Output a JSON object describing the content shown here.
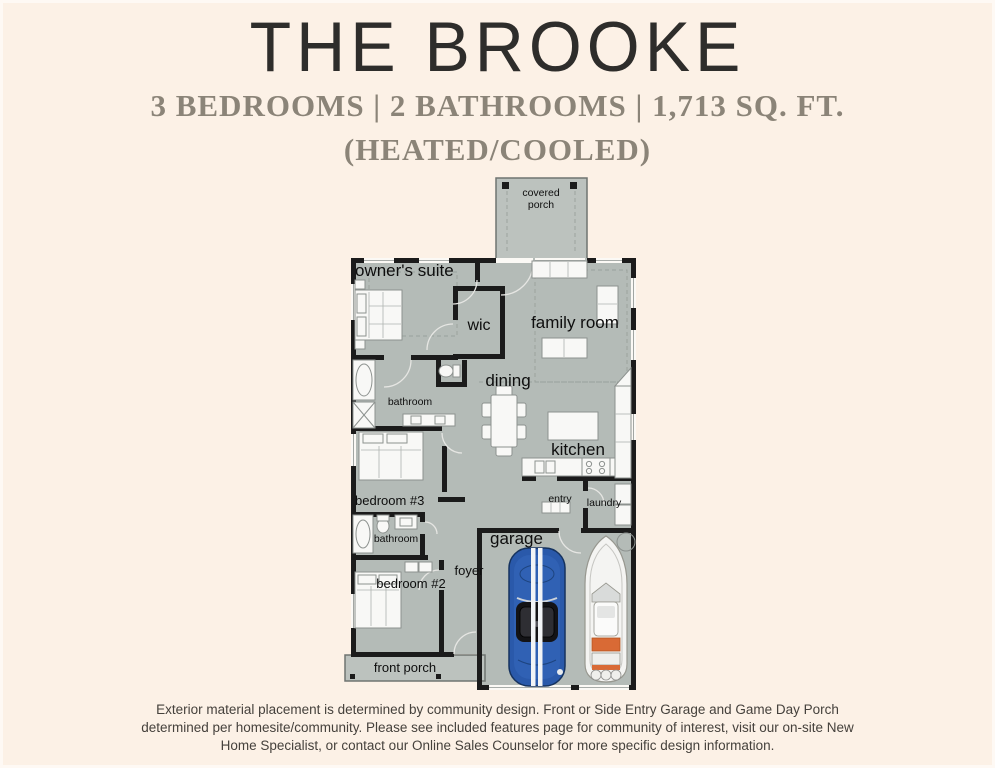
{
  "header": {
    "title": "THE BROOKE",
    "subtitle": "3 BEDROOMS | 2 BATHROOMS | 1,713 SQ. FT.",
    "subtitle2": "(HEATED/COOLED)"
  },
  "floorplan": {
    "rooms": {
      "covered_porch_1": "covered",
      "covered_porch_2": "porch",
      "owners_suite": "owner's suite",
      "wic": "wic",
      "family_room": "family room",
      "dining": "dining",
      "kitchen": "kitchen",
      "bathroom_owner": "bathroom",
      "bedroom_3": "bedroom #3",
      "entry": "entry",
      "laundry": "laundry",
      "bathroom_hall": "bathroom",
      "garage": "garage",
      "foyer": "foyer",
      "bedroom_2": "bedroom #2",
      "front_porch": "front porch"
    },
    "colors": {
      "background": "#fcf1e6",
      "floor": "#b4bbb7",
      "wall": "#1b1b1b",
      "car_blue": "#2a59aa",
      "boat_accent": "#d96a35",
      "subtitle_gray": "#8b8478"
    }
  },
  "footer": {
    "disclaimer": "Exterior material placement is determined by community design. Front or Side Entry Garage and Game Day Porch determined per homesite/community. Please see included features page for community of interest, visit our on-site New Home Specialist, or contact our Online Sales Counselor for more specific design information."
  }
}
